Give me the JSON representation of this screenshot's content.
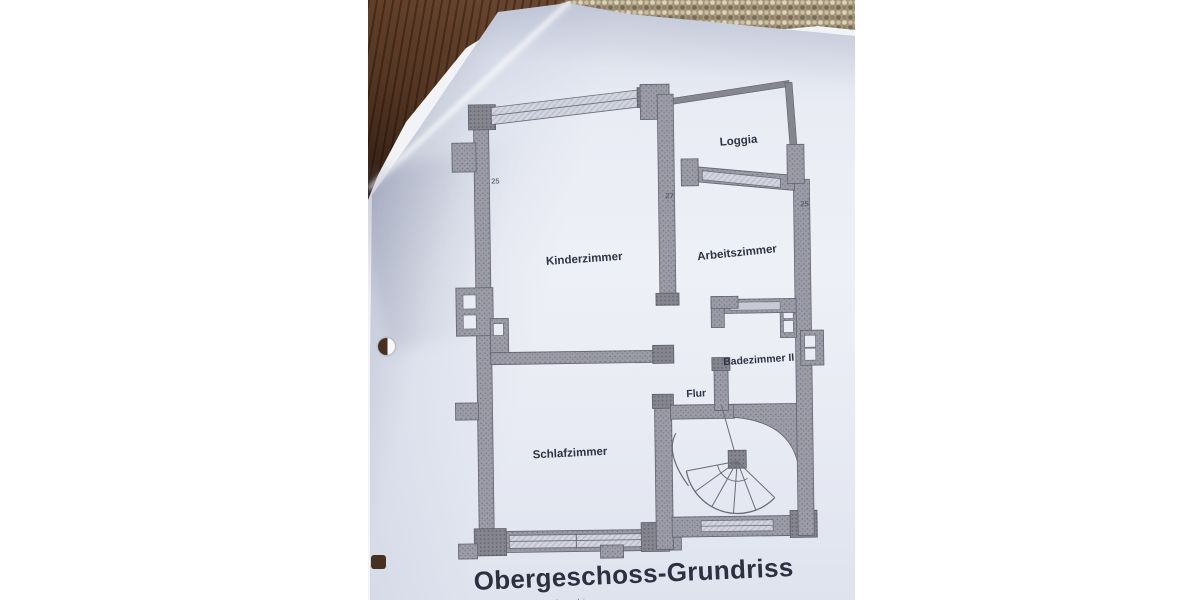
{
  "scene": {
    "type": "photo of a paper floor plan lying on a dark wooden surface beside beige woven fabric",
    "background_color": "#ffffff",
    "wood_color": "#543622",
    "fabric_color": "#a3957a",
    "paper_color": "#e9ecf4",
    "ink_color": "#6b6c78",
    "label_color": "#2e3444"
  },
  "floorplan": {
    "title": "Obergeschoss-Grundriss",
    "subcaption_fragment": "… Grundriss",
    "rooms": [
      {
        "label": "Loggia"
      },
      {
        "label": "Kinderzimmer"
      },
      {
        "label": "Arbeitszimmer"
      },
      {
        "label": "Badezimmer II"
      },
      {
        "label": "Flur"
      },
      {
        "label": "Schlafzimmer"
      }
    ],
    "wall_annotations": [
      "25",
      "27",
      "25"
    ],
    "features": [
      "spiral-staircase",
      "window-bands",
      "chimney-flues",
      "punched-holes"
    ]
  }
}
